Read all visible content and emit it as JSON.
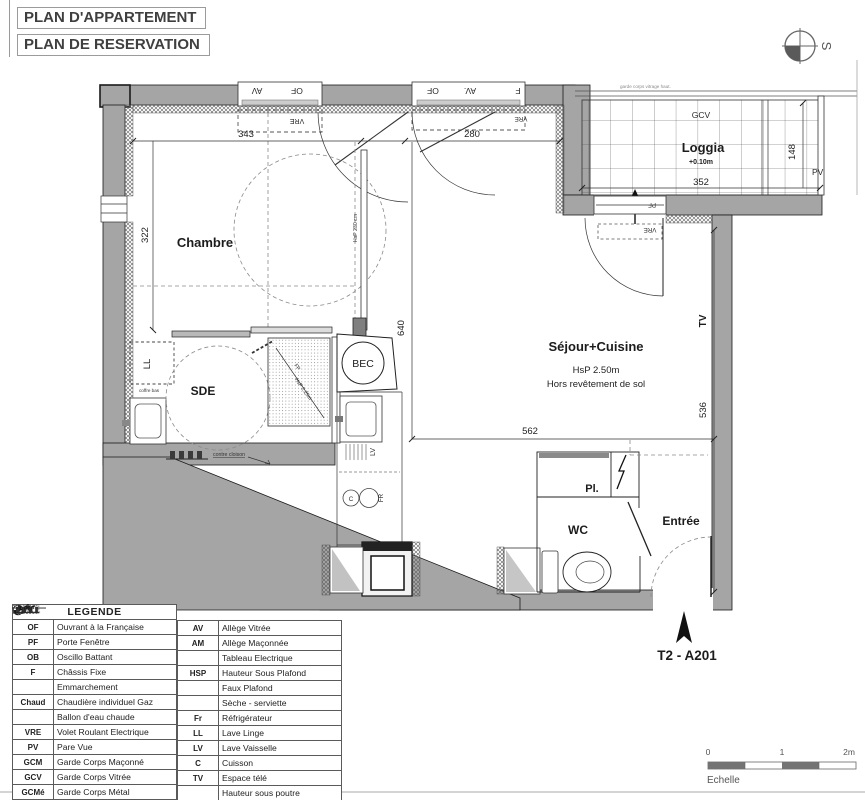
{
  "header": {
    "title1": "PLAN D'APPARTEMENT",
    "title2": "PLAN DE RESERVATION"
  },
  "compass": {
    "s": "S"
  },
  "plan": {
    "chambre": {
      "label": "Chambre",
      "hsp": "HsP 230 cm"
    },
    "sde": {
      "label": "SDE",
      "ll": "LL",
      "coffre": "coffre bas",
      "cloison": "contre cloison"
    },
    "fp": {
      "label": "FP",
      "hsp": "HsP 2.25m"
    },
    "bec": "BEC",
    "sejour": {
      "label": "Séjour+Cuisine",
      "hsp": "HsP 2.50m",
      "note": "Hors revêtement de sol"
    },
    "loggia": {
      "label": "Loggia",
      "level": "+0.10m",
      "gcv": "GCV",
      "pv": "PV",
      "note": "garde corps vitrage haut."
    },
    "wc": "WC",
    "pl": "Pl.",
    "entree": "Entrée",
    "tv": "TV",
    "kitchen": {
      "lv": "LV",
      "c": "C",
      "fr": "FR"
    },
    "win": {
      "av": "AV",
      "of": "OF",
      "av2": "AV.",
      "f": "F",
      "vre": "VRE",
      "pf": "PF"
    },
    "dims": {
      "w343": "343",
      "w322": "322",
      "w280": "280",
      "w562": "562",
      "h536": "536",
      "h640": "640",
      "loggia_w": "352",
      "loggia_h": "148"
    }
  },
  "apartment": {
    "label": "T2 - A201"
  },
  "scale": {
    "zero": "0",
    "one": "1",
    "two": "2m",
    "label": "Echelle"
  },
  "legend": {
    "title": "LEGENDE",
    "left": [
      {
        "abbr": "OF",
        "label": "Ouvrant à la Française"
      },
      {
        "abbr": "PF",
        "label": "Porte Fenêtre"
      },
      {
        "abbr": "OB",
        "label": "Oscillo Battant"
      },
      {
        "abbr": "F",
        "label": "Châssis Fixe"
      },
      {
        "abbr": "",
        "icon": "emmarchement-icon",
        "label": "Emmarchement"
      },
      {
        "abbr": "Chaud",
        "label": "Chaudière individuel Gaz"
      },
      {
        "abbr": "",
        "icon": "ballon-eau-chaude-icon",
        "label": "Ballon d'eau chaude"
      },
      {
        "abbr": "VRE",
        "label": "Volet Roulant Electrique"
      },
      {
        "abbr": "PV",
        "label": "Pare Vue"
      },
      {
        "abbr": "GCM",
        "label": "Garde Corps Maçonné"
      },
      {
        "abbr": "GCV",
        "label": "Garde Corps Vitrée"
      },
      {
        "abbr": "GCMé",
        "label": "Garde Corps Métal"
      }
    ],
    "right": [
      {
        "abbr": "AV",
        "label": "Allège Vitrée"
      },
      {
        "abbr": "AM",
        "label": "Allège Maçonnée"
      },
      {
        "abbr": "",
        "icon": "tableau-electrique-icon",
        "label": "Tableau Electrique"
      },
      {
        "abbr": "HSP",
        "label": "Hauteur Sous Plafond"
      },
      {
        "abbr": "",
        "icon": "faux-plafond-icon",
        "label": "Faux Plafond"
      },
      {
        "abbr": "",
        "icon": "seche-serviette-icon",
        "label": "Sèche - serviette"
      },
      {
        "abbr": "Fr",
        "label": "Réfrigérateur"
      },
      {
        "abbr": "LL",
        "label": "Lave Linge"
      },
      {
        "abbr": "LV",
        "label": "Lave Vaisselle"
      },
      {
        "abbr": "C",
        "label": "Cuisson"
      },
      {
        "abbr": "TV",
        "label": "Espace télé"
      },
      {
        "abbr": "",
        "icon": "hauteur-sous-poutre-icon",
        "label": "Hauteur sous poutre"
      }
    ]
  }
}
